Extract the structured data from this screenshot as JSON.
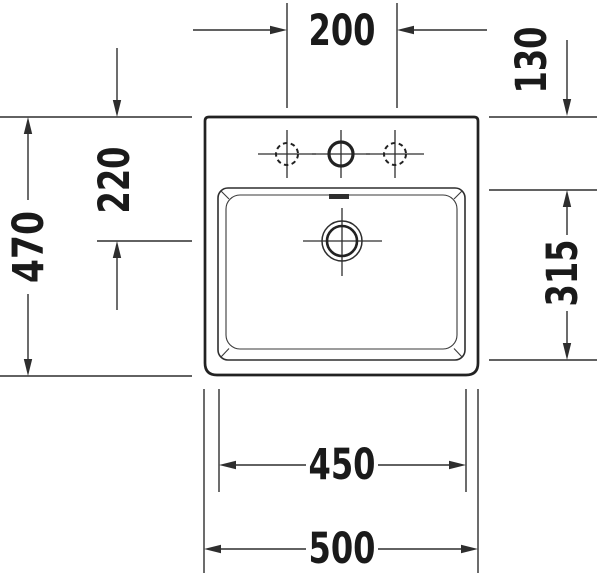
{
  "drawing": {
    "dimensions": {
      "tap_hole_spacing": "200",
      "top_edge_to_bowl": "130",
      "top_edge_to_drain": "220",
      "overall_depth": "470",
      "bowl_depth": "315",
      "bowl_width": "450",
      "overall_width": "500"
    },
    "colors": {
      "line": "#2e2e2e",
      "outline": "#222222",
      "text": "#1a1a1a",
      "background": "#ffffff"
    }
  }
}
